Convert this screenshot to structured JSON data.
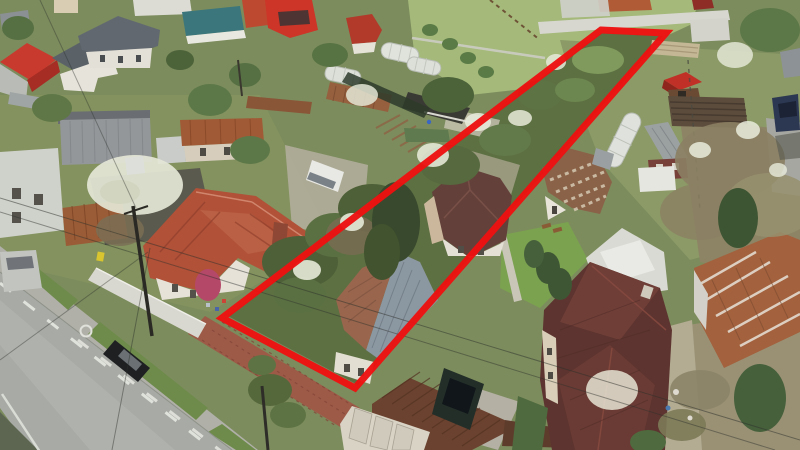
{
  "image": {
    "description": "Aerial drone photograph of a residential neighborhood in spring: an asphalt road with dashed white lane markings runs along the lower left, rows of houses with terracotta, gray, maroon, red and rusty corrugated roofs sit among green gardens, greenhouses and blossoming trees, and a long narrow land parcel overgrown with trees is highlighted by a thick red boundary outline running diagonally from the road up to the back gardens.",
    "type": "aerial-photograph",
    "orientation": "oblique top-down"
  },
  "plot_boundary": {
    "color": "#ed1111",
    "stroke_width": 7,
    "shape": "long narrow quadrilateral",
    "points": [
      [
        601,
        30
      ],
      [
        666,
        33
      ],
      [
        355,
        388
      ],
      [
        222,
        318
      ]
    ]
  },
  "road": {
    "surface_color": "#a7aaa5",
    "marking_color": "#e6e8e1",
    "markings": [
      "dashed center line",
      "dashed edge line",
      "solid edge line",
      "painted circle"
    ],
    "runs": "upper-left to bottom-center"
  },
  "vehicles": [
    {
      "name": "black-car",
      "color": "#1e2022",
      "location": "parked on road"
    },
    {
      "name": "dark-suv",
      "color": "#232e29",
      "location": "driveway by garage"
    },
    {
      "name": "white-van-left",
      "color": "#e8e8e4",
      "location": "gravel yard"
    },
    {
      "name": "white-van-right",
      "color": "#e6e6e0",
      "location": "right garden"
    },
    {
      "name": "gray-van",
      "color": "#c2c4c0",
      "location": "top left road edge"
    },
    {
      "name": "blue-car",
      "color": "#2c3752",
      "location": "top right pavement"
    }
  ],
  "buildings": [
    {
      "name": "terracotta-roof-house",
      "roof_color": "#b05138"
    },
    {
      "name": "plot-house-brown-gray-roof",
      "roof_color": "#99664d"
    },
    {
      "name": "brown-garage",
      "roof_color": "#6b422f"
    },
    {
      "name": "maroon-house-mid",
      "roof_color": "#63413a"
    },
    {
      "name": "large-maroon-house",
      "roof_color": "#5d342f"
    },
    {
      "name": "checkered-roof-house",
      "roof_color": "#8a6248"
    },
    {
      "name": "rusty-corrugated-building",
      "roof_color": "#a3613d"
    },
    {
      "name": "red-gable-house",
      "roof_color": "#c8392e"
    },
    {
      "name": "gray-slate-houses",
      "roof_color": "#5d646c"
    },
    {
      "name": "teal-roof-building",
      "roof_color": "#3a767c"
    },
    {
      "name": "red-garden-shed",
      "roof_color": "#c03026"
    },
    {
      "name": "greenhouses",
      "roof_color": "#e0e3dc"
    }
  ],
  "palette": {
    "grass": "#7c8c5d",
    "field": "#a4b97a",
    "dark_shrub": "#4e6038",
    "blossom": "#e7ead9",
    "sidewalk": "#b0b0a8",
    "brick_walk": "#9d5a47",
    "white_wall": "#d9d8d0",
    "dry_trees": "#8b7f63"
  }
}
